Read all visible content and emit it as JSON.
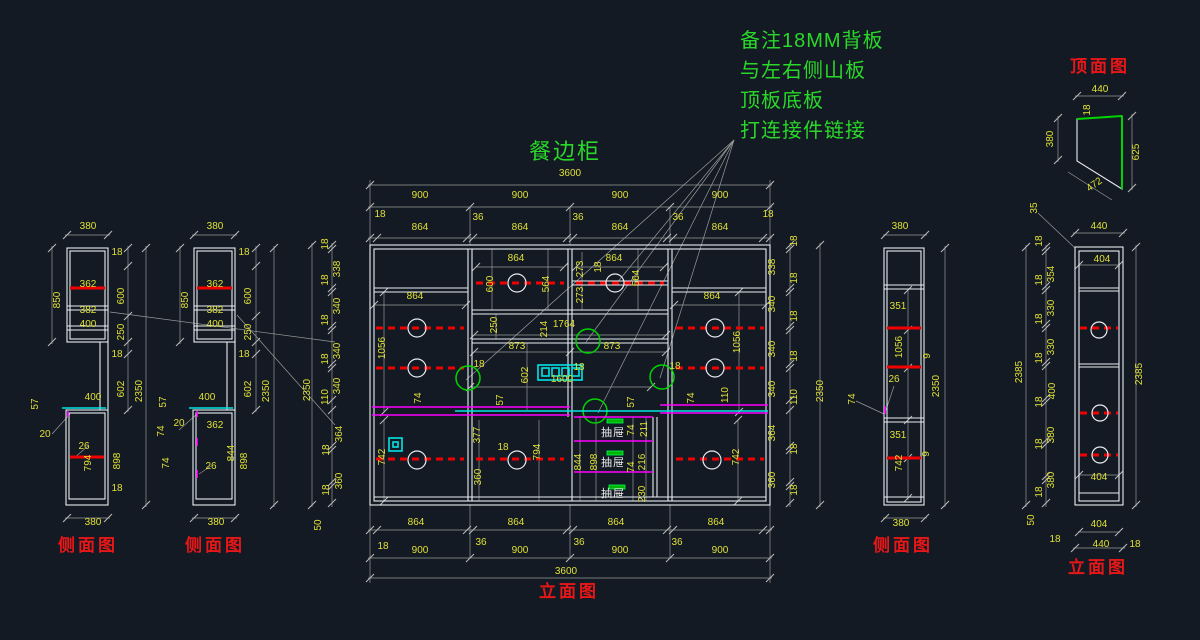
{
  "title": "餐边柜",
  "notes": [
    "备注18MM背板",
    "与左右侧山板",
    "顶板底板",
    "打连接件链接"
  ],
  "colors": {
    "background": "#131a23",
    "dimension_text": "#e0e034",
    "geometry_white": "#e8edf2",
    "shelf_red": "#f00000",
    "drawer_magenta": "#ff00ff",
    "counter_cyan": "#00e5e5",
    "highlight_green": "#00d400",
    "view_label_red": "#e81717",
    "dim_line_gray": "#9a9a9a"
  },
  "labels": [
    [
      "380",
      88,
      229
    ],
    [
      "18",
      117,
      255
    ],
    [
      "850",
      60,
      300,
      -90
    ],
    [
      "600",
      124,
      296,
      -90
    ],
    [
      "362",
      88,
      287
    ],
    [
      "382",
      88,
      313
    ],
    [
      "400",
      88,
      327
    ],
    [
      "250",
      124,
      332,
      -90
    ],
    [
      "18",
      117,
      357
    ],
    [
      "602",
      124,
      389,
      -90
    ],
    [
      "2350",
      142,
      391,
      -90
    ],
    [
      "400",
      93,
      400
    ],
    [
      "57",
      38,
      404,
      -90
    ],
    [
      "20",
      45,
      437
    ],
    [
      "26",
      84,
      449
    ],
    [
      "794",
      91,
      463,
      -90
    ],
    [
      "898",
      120,
      461,
      -90
    ],
    [
      "18",
      117,
      491
    ],
    [
      "380",
      93,
      525
    ],
    [
      "380",
      215,
      229
    ],
    [
      "18",
      244,
      255
    ],
    [
      "850",
      188,
      300,
      -90
    ],
    [
      "600",
      251,
      296,
      -90
    ],
    [
      "362",
      215,
      287
    ],
    [
      "382",
      215,
      313
    ],
    [
      "400",
      215,
      327
    ],
    [
      "250",
      251,
      332,
      -90
    ],
    [
      "18",
      244,
      357
    ],
    [
      "602",
      251,
      389,
      -90
    ],
    [
      "2350",
      269,
      391,
      -90
    ],
    [
      "400",
      207,
      400
    ],
    [
      "57",
      166,
      402,
      -90
    ],
    [
      "74",
      164,
      431,
      -90
    ],
    [
      "20",
      179,
      426
    ],
    [
      "74",
      169,
      463,
      -90
    ],
    [
      "362",
      215,
      428
    ],
    [
      "844",
      234,
      453,
      -90
    ],
    [
      "26",
      211,
      469
    ],
    [
      "898",
      247,
      461,
      -90
    ],
    [
      "380",
      216,
      525
    ],
    [
      "3600",
      570,
      176
    ],
    [
      "900",
      420,
      198
    ],
    [
      "900",
      520,
      198
    ],
    [
      "900",
      620,
      198
    ],
    [
      "900",
      720,
      198
    ],
    [
      "18",
      380,
      217
    ],
    [
      "36",
      478,
      220
    ],
    [
      "36",
      578,
      220
    ],
    [
      "36",
      678,
      220
    ],
    [
      "18",
      768,
      217
    ],
    [
      "864",
      420,
      230
    ],
    [
      "864",
      520,
      230
    ],
    [
      "864",
      620,
      230
    ],
    [
      "864",
      720,
      230
    ],
    [
      "2350",
      310,
      390,
      -90
    ],
    [
      "18",
      328,
      244,
      -90
    ],
    [
      "338",
      340,
      269,
      -90
    ],
    [
      "18",
      328,
      280,
      -90
    ],
    [
      "340",
      340,
      306,
      -90
    ],
    [
      "18",
      328,
      320,
      -90
    ],
    [
      "340",
      340,
      351,
      -90
    ],
    [
      "18",
      328,
      359,
      -90
    ],
    [
      "340",
      340,
      386,
      -90
    ],
    [
      "110",
      328,
      397,
      -90
    ],
    [
      "364",
      342,
      434,
      -90
    ],
    [
      "18",
      329,
      450,
      -90
    ],
    [
      "360",
      342,
      481,
      -90
    ],
    [
      "18",
      329,
      490,
      -90
    ],
    [
      "50",
      321,
      525,
      -90
    ],
    [
      "2350",
      823,
      391,
      -90
    ],
    [
      "18",
      797,
      241,
      -90
    ],
    [
      "338",
      775,
      267,
      -90
    ],
    [
      "18",
      797,
      278,
      -90
    ],
    [
      "340",
      775,
      304,
      -90
    ],
    [
      "18",
      797,
      316,
      -90
    ],
    [
      "340",
      775,
      349,
      -90
    ],
    [
      "18",
      797,
      356,
      -90
    ],
    [
      "340",
      775,
      389,
      -90
    ],
    [
      "110",
      797,
      397,
      -90
    ],
    [
      "364",
      775,
      433,
      -90
    ],
    [
      "18",
      797,
      449,
      -90
    ],
    [
      "360",
      775,
      480,
      -90
    ],
    [
      "18",
      797,
      490,
      -90
    ],
    [
      "864",
      415,
      299
    ],
    [
      "1056",
      385,
      348,
      -90
    ],
    [
      "18",
      479,
      367
    ],
    [
      "864",
      516,
      261
    ],
    [
      "600",
      493,
      284,
      -90
    ],
    [
      "564",
      549,
      284,
      -90
    ],
    [
      "273",
      583,
      269,
      -90
    ],
    [
      "18",
      601,
      267,
      -90
    ],
    [
      "273",
      583,
      295,
      -90
    ],
    [
      "864",
      614,
      261
    ],
    [
      "564",
      639,
      278,
      -90
    ],
    [
      "250",
      497,
      325,
      -90
    ],
    [
      "214",
      547,
      329,
      -90
    ],
    [
      "1764",
      564,
      327
    ],
    [
      "873",
      517,
      349
    ],
    [
      "873",
      612,
      349
    ],
    [
      "602",
      528,
      375,
      -90
    ],
    [
      "18",
      579,
      370
    ],
    [
      "1600",
      562,
      382
    ],
    [
      "57",
      503,
      400,
      -90
    ],
    [
      "57",
      634,
      402,
      -90
    ],
    [
      "864",
      712,
      299
    ],
    [
      "1056",
      740,
      342,
      -90
    ],
    [
      "18",
      675,
      369
    ],
    [
      "74",
      421,
      398,
      -90
    ],
    [
      "74",
      694,
      398,
      -90
    ],
    [
      "110",
      728,
      395,
      -90
    ],
    [
      "742",
      385,
      457,
      -90
    ],
    [
      "377",
      480,
      435,
      -90
    ],
    [
      "360",
      481,
      477,
      -90
    ],
    [
      "18",
      503,
      450
    ],
    [
      "794",
      540,
      452,
      -90
    ],
    [
      "844",
      581,
      462,
      -90
    ],
    [
      "898",
      597,
      462,
      -90
    ],
    [
      "74",
      634,
      430,
      -90
    ],
    [
      "211",
      647,
      429,
      -90
    ],
    [
      "74",
      634,
      467,
      -90
    ],
    [
      "216",
      645,
      462,
      -90
    ],
    [
      "230",
      645,
      494,
      -90
    ],
    [
      "742",
      739,
      457,
      -90
    ],
    [
      "抽屉",
      613,
      436,
      0,
      "w"
    ],
    [
      "抽屉",
      613,
      466,
      0,
      "w"
    ],
    [
      "抽屉",
      613,
      497,
      0,
      "w"
    ],
    [
      "864",
      416,
      525
    ],
    [
      "864",
      516,
      525
    ],
    [
      "864",
      616,
      525
    ],
    [
      "864",
      716,
      525
    ],
    [
      "18",
      383,
      549
    ],
    [
      "36",
      481,
      545
    ],
    [
      "36",
      579,
      545
    ],
    [
      "36",
      677,
      545
    ],
    [
      "900",
      420,
      553
    ],
    [
      "900",
      520,
      553
    ],
    [
      "900",
      620,
      553
    ],
    [
      "900",
      720,
      553
    ],
    [
      "3600",
      566,
      574
    ],
    [
      "380",
      900,
      229
    ],
    [
      "351",
      898,
      309
    ],
    [
      "1056",
      902,
      347,
      -90
    ],
    [
      "9",
      930,
      356,
      -90
    ],
    [
      "26",
      894,
      382
    ],
    [
      "74",
      855,
      399,
      -90
    ],
    [
      "2350",
      939,
      386,
      -90
    ],
    [
      "351",
      898,
      438
    ],
    [
      "742",
      902,
      463,
      -90
    ],
    [
      "9",
      929,
      454,
      -90
    ],
    [
      "380",
      901,
      526
    ],
    [
      "35",
      1037,
      208,
      -90
    ],
    [
      "440",
      1099,
      229
    ],
    [
      "18",
      1042,
      241,
      -90
    ],
    [
      "404",
      1102,
      262
    ],
    [
      "354",
      1054,
      274,
      -90
    ],
    [
      "18",
      1042,
      280,
      -90
    ],
    [
      "330",
      1054,
      308,
      -90
    ],
    [
      "18",
      1042,
      319,
      -90
    ],
    [
      "330",
      1054,
      347,
      -90
    ],
    [
      "18",
      1042,
      358,
      -90
    ],
    [
      "400",
      1055,
      391,
      -90
    ],
    [
      "2385",
      1022,
      372,
      -90
    ],
    [
      "2385",
      1142,
      374,
      -90
    ],
    [
      "18",
      1042,
      402,
      -90
    ],
    [
      "380",
      1054,
      435,
      -90
    ],
    [
      "18",
      1042,
      444,
      -90
    ],
    [
      "380",
      1054,
      480,
      -90
    ],
    [
      "18",
      1042,
      492,
      -90
    ],
    [
      "50",
      1034,
      520,
      -90
    ],
    [
      "404",
      1099,
      480
    ],
    [
      "404",
      1099,
      527
    ],
    [
      "18",
      1055,
      542
    ],
    [
      "440",
      1101,
      547
    ],
    [
      "18",
      1135,
      547
    ],
    [
      "440",
      1100,
      92
    ],
    [
      "18",
      1090,
      110,
      -90
    ],
    [
      "380",
      1053,
      139,
      -90
    ],
    [
      "625",
      1139,
      152,
      -90
    ],
    [
      "472",
      1096,
      187,
      -35
    ],
    [
      "侧面图",
      88,
      551,
      0,
      "vl"
    ],
    [
      "侧面图",
      215,
      551,
      0,
      "vl"
    ],
    [
      "立面图",
      569,
      597,
      0,
      "vl"
    ],
    [
      "侧面图",
      903,
      551,
      0,
      "vl"
    ],
    [
      "立面图",
      1098,
      573,
      0,
      "vl"
    ],
    [
      "顶面图",
      1100,
      72,
      0,
      "vl"
    ]
  ]
}
